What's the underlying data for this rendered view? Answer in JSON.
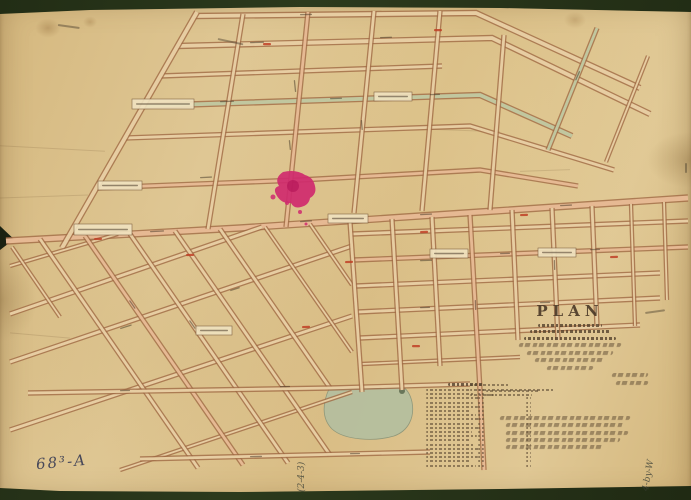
{
  "scan": {
    "background_color": "#2c3a1d",
    "paper_color": "#dcc18c",
    "street_outline_color": "#a06a45",
    "street_fill_color": "#ead2a6",
    "street_pink_color": "#e9bd97",
    "street_green_color": "#c2cba3"
  },
  "title_block": {
    "title": "PLAN",
    "caps_line_widths": [
      64,
      80,
      92
    ],
    "script_line_widths": [
      102,
      86,
      70,
      46
    ],
    "signature_line_widths": [
      36,
      32
    ],
    "scale_line_widths": [
      40,
      84,
      24
    ]
  },
  "reference_table": {
    "heading_width": 36,
    "subheading_widths": [
      54,
      46
    ],
    "row_count": 19
  },
  "notes_block": {
    "line_widths": [
      130,
      118,
      122,
      114,
      96
    ]
  },
  "annotations": {
    "catalog_number": "68³-A",
    "bottom_margin_note": "(2-4-3)",
    "right_margin_note": "4-by-W"
  },
  "map": {
    "highlight_color": "#cf2a6e",
    "pond_color": "#b6bf9f",
    "pond_edge_color": "#8c967a",
    "streets": [
      {
        "pts": [
          [
            195,
            16
          ],
          [
            476,
            13
          ],
          [
            640,
            88
          ]
        ],
        "w": 5,
        "c": "base"
      },
      {
        "pts": [
          [
            177,
            46
          ],
          [
            492,
            38
          ],
          [
            650,
            114
          ]
        ],
        "w": 5,
        "c": "base"
      },
      {
        "pts": [
          [
            160,
            76
          ],
          [
            442,
            66
          ]
        ],
        "w": 4,
        "c": "base"
      },
      {
        "pts": [
          [
            143,
            106
          ],
          [
            480,
            95
          ],
          [
            572,
            136
          ]
        ],
        "w": 5,
        "c": "green"
      },
      {
        "pts": [
          [
            125,
            138
          ],
          [
            470,
            126
          ],
          [
            614,
            170
          ]
        ],
        "w": 4,
        "c": "base"
      },
      {
        "pts": [
          [
            96,
            188
          ],
          [
            300,
            180
          ],
          [
            480,
            170
          ],
          [
            578,
            186
          ]
        ],
        "w": 4,
        "c": "pink"
      },
      {
        "pts": [
          [
            6,
            241
          ],
          [
            240,
            228
          ],
          [
            480,
            212
          ],
          [
            688,
            198
          ]
        ],
        "w": 6,
        "c": "pink"
      },
      {
        "pts": [
          [
            197,
            12
          ],
          [
            62,
            248
          ]
        ],
        "w": 5,
        "c": "base"
      },
      {
        "pts": [
          [
            243,
            14
          ],
          [
            208,
            229
          ]
        ],
        "w": 4,
        "c": "base"
      },
      {
        "pts": [
          [
            308,
            12
          ],
          [
            286,
            227
          ]
        ],
        "w": 4,
        "c": "pink"
      },
      {
        "pts": [
          [
            374,
            11
          ],
          [
            354,
            213
          ]
        ],
        "w": 4,
        "c": "base"
      },
      {
        "pts": [
          [
            440,
            11
          ],
          [
            422,
            211
          ]
        ],
        "w": 4,
        "c": "base"
      },
      {
        "pts": [
          [
            504,
            35
          ],
          [
            490,
            210
          ]
        ],
        "w": 4,
        "c": "base"
      },
      {
        "pts": [
          [
            597,
            28
          ],
          [
            548,
            150
          ]
        ],
        "w": 4,
        "c": "green"
      },
      {
        "pts": [
          [
            648,
            56
          ],
          [
            606,
            162
          ]
        ],
        "w": 3,
        "c": "base"
      },
      {
        "pts": [
          [
            10,
            266
          ],
          [
            118,
            234
          ]
        ],
        "w": 3,
        "c": "base"
      },
      {
        "pts": [
          [
            10,
            314
          ],
          [
            262,
            227
          ]
        ],
        "w": 4,
        "c": "base"
      },
      {
        "pts": [
          [
            10,
            362
          ],
          [
            352,
            246
          ]
        ],
        "w": 4,
        "c": "base"
      },
      {
        "pts": [
          [
            10,
            430
          ],
          [
            352,
            316
          ]
        ],
        "w": 4,
        "c": "base"
      },
      {
        "pts": [
          [
            120,
            470
          ],
          [
            352,
            392
          ]
        ],
        "w": 3,
        "c": "base"
      },
      {
        "pts": [
          [
            12,
            247
          ],
          [
            60,
            317
          ]
        ],
        "w": 3,
        "c": "base"
      },
      {
        "pts": [
          [
            40,
            239
          ],
          [
            198,
            468
          ]
        ],
        "w": 4,
        "c": "base"
      },
      {
        "pts": [
          [
            85,
            236
          ],
          [
            243,
            465
          ]
        ],
        "w": 4,
        "c": "pink"
      },
      {
        "pts": [
          [
            130,
            234
          ],
          [
            288,
            463
          ]
        ],
        "w": 4,
        "c": "base"
      },
      {
        "pts": [
          [
            175,
            231
          ],
          [
            330,
            455
          ]
        ],
        "w": 4,
        "c": "base"
      },
      {
        "pts": [
          [
            220,
            229
          ],
          [
            330,
            388
          ]
        ],
        "w": 4,
        "c": "base"
      },
      {
        "pts": [
          [
            265,
            227
          ],
          [
            352,
            352
          ]
        ],
        "w": 3,
        "c": "base"
      },
      {
        "pts": [
          [
            310,
            224
          ],
          [
            352,
            285
          ]
        ],
        "w": 3,
        "c": "base"
      },
      {
        "pts": [
          [
            28,
            393
          ],
          [
            330,
            388
          ],
          [
            470,
            384
          ]
        ],
        "w": 4,
        "c": "base"
      },
      {
        "pts": [
          [
            140,
            459
          ],
          [
            430,
            452
          ]
        ],
        "w": 4,
        "c": "base"
      },
      {
        "pts": [
          [
            352,
            234
          ],
          [
            688,
            221
          ]
        ],
        "w": 4,
        "c": "base"
      },
      {
        "pts": [
          [
            354,
            260
          ],
          [
            688,
            247
          ]
        ],
        "w": 4,
        "c": "pink"
      },
      {
        "pts": [
          [
            356,
            286
          ],
          [
            660,
            273
          ]
        ],
        "w": 4,
        "c": "base"
      },
      {
        "pts": [
          [
            358,
            312
          ],
          [
            660,
            298
          ]
        ],
        "w": 4,
        "c": "base"
      },
      {
        "pts": [
          [
            360,
            338
          ],
          [
            640,
            325
          ]
        ],
        "w": 4,
        "c": "base"
      },
      {
        "pts": [
          [
            362,
            364
          ],
          [
            520,
            357
          ]
        ],
        "w": 3,
        "c": "base"
      },
      {
        "pts": [
          [
            350,
            222
          ],
          [
            362,
            392
          ]
        ],
        "w": 4,
        "c": "base"
      },
      {
        "pts": [
          [
            392,
            219
          ],
          [
            402,
            390
          ]
        ],
        "w": 4,
        "c": "base"
      },
      {
        "pts": [
          [
            432,
            217
          ],
          [
            440,
            366
          ]
        ],
        "w": 4,
        "c": "base"
      },
      {
        "pts": [
          [
            470,
            215
          ],
          [
            480,
            390
          ],
          [
            484,
            470
          ]
        ],
        "w": 4,
        "c": "pink"
      },
      {
        "pts": [
          [
            512,
            210
          ],
          [
            518,
            340
          ]
        ],
        "w": 4,
        "c": "base"
      },
      {
        "pts": [
          [
            552,
            208
          ],
          [
            558,
            340
          ]
        ],
        "w": 4,
        "c": "base"
      },
      {
        "pts": [
          [
            592,
            206
          ],
          [
            597,
            326
          ]
        ],
        "w": 4,
        "c": "base"
      },
      {
        "pts": [
          [
            631,
            204
          ],
          [
            635,
            326
          ]
        ],
        "w": 3,
        "c": "base"
      },
      {
        "pts": [
          [
            664,
            202
          ],
          [
            667,
            300
          ]
        ],
        "w": 3,
        "c": "base"
      }
    ],
    "label_boxes": [
      [
        132,
        99,
        62,
        10
      ],
      [
        74,
        224,
        58,
        11
      ],
      [
        328,
        214,
        40,
        9
      ],
      [
        98,
        181,
        44,
        9
      ],
      [
        374,
        92,
        38,
        9
      ],
      [
        430,
        249,
        38,
        9
      ],
      [
        538,
        248,
        38,
        9
      ],
      [
        196,
        326,
        36,
        9
      ]
    ],
    "street_name_marks": [
      [
        250,
        42,
        -2,
        14
      ],
      [
        380,
        37,
        -2,
        12
      ],
      [
        220,
        101,
        -2,
        14
      ],
      [
        330,
        98,
        -2,
        12
      ],
      [
        430,
        94,
        -2,
        10
      ],
      [
        200,
        177,
        -3,
        12
      ],
      [
        150,
        231,
        -3,
        14
      ],
      [
        300,
        221,
        -4,
        12
      ],
      [
        420,
        214,
        -3,
        12
      ],
      [
        560,
        205,
        -3,
        12
      ],
      [
        295,
        80,
        84,
        12
      ],
      [
        290,
        140,
        84,
        10
      ],
      [
        362,
        120,
        85,
        10
      ],
      [
        420,
        260,
        -2,
        12
      ],
      [
        500,
        253,
        -2,
        10
      ],
      [
        590,
        249,
        -2,
        10
      ],
      [
        420,
        307,
        -2,
        10
      ],
      [
        540,
        302,
        -2,
        10
      ],
      [
        555,
        260,
        88,
        10
      ],
      [
        130,
        300,
        55,
        10
      ],
      [
        190,
        320,
        55,
        10
      ],
      [
        120,
        328,
        -18,
        12
      ],
      [
        230,
        290,
        -18,
        10
      ],
      [
        250,
        456,
        -1,
        12
      ],
      [
        350,
        453,
        -1,
        10
      ],
      [
        476,
        300,
        88,
        10
      ],
      [
        300,
        14,
        -1,
        12
      ],
      [
        575,
        80,
        -66,
        10
      ],
      [
        120,
        390,
        -1,
        10
      ],
      [
        280,
        386,
        -1,
        10
      ]
    ],
    "red_marks": [
      [
        263,
        43,
        0
      ],
      [
        434,
        29,
        0
      ],
      [
        610,
        256,
        -2
      ],
      [
        345,
        261,
        -2
      ],
      [
        302,
        326,
        -2
      ],
      [
        186,
        254,
        -2
      ],
      [
        420,
        231,
        -2
      ],
      [
        520,
        214,
        -2
      ],
      [
        94,
        238,
        -2
      ],
      [
        412,
        345,
        0
      ]
    ],
    "ink_marks": [
      [
        58,
        24,
        8,
        22
      ],
      [
        218,
        38,
        12,
        26
      ],
      [
        645,
        312,
        -8,
        20
      ],
      [
        687,
        163,
        90,
        10
      ]
    ],
    "pink_blob": {
      "cx": 293,
      "cy": 186,
      "path": "M283,172 q-9,6 -4,14 q-7,2 -2,10 q5,8 14,7 q3,6 10,4 q8,-2 9,-9 q7,-4 5,-12 q-2,-9 -10,-11 q-9,-6 -22,-3 Z",
      "satellites": [
        [
          273,
          197,
          2.5
        ],
        [
          287,
          203,
          2
        ],
        [
          300,
          212,
          2
        ],
        [
          306,
          224,
          1.5
        ]
      ]
    },
    "pond": {
      "path": "M329,389 C323,402 321,418 332,429 C344,440 374,442 394,436 C408,431 415,418 412,402 C410,393 406,389 404,388 Z",
      "dark_spot": [
        402,
        391,
        3
      ]
    }
  }
}
